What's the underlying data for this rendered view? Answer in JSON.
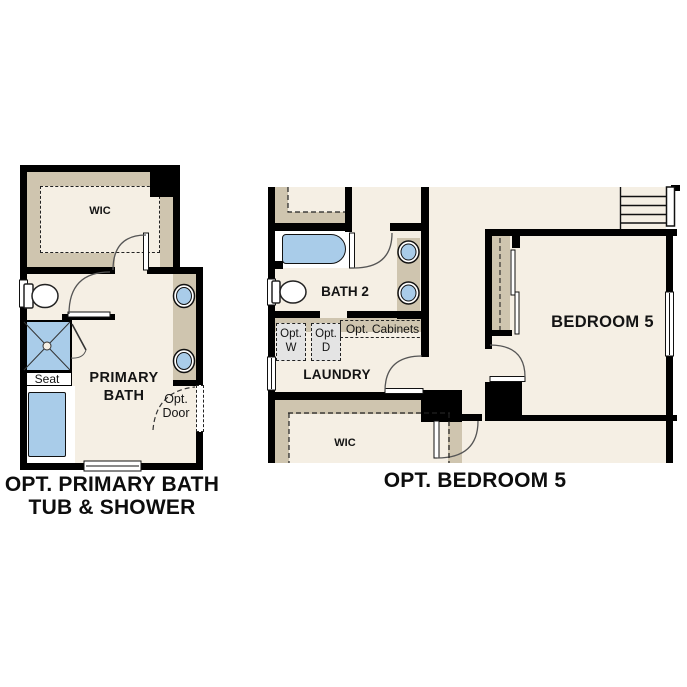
{
  "colors": {
    "floor": "#f5efe4",
    "cabinet": "#cfc5af",
    "fixture_blue": "#a9cce9",
    "appliance_gray": "#e4e4e4",
    "wall": "#000000",
    "ink": "#111111"
  },
  "left_plan": {
    "caption_line1": "OPT. PRIMARY BATH",
    "caption_line2": "TUB & SHOWER",
    "wic_label": "WIC",
    "room_line1": "PRIMARY",
    "room_line2": "BATH",
    "seat_label": "Seat",
    "opt_door_line1": "Opt.",
    "opt_door_line2": "Door"
  },
  "right_plan": {
    "caption": "OPT. BEDROOM 5",
    "bath_label": "BATH 2",
    "laundry_label": "LAUNDRY",
    "wic_label": "WIC",
    "bedroom_label": "BEDROOM 5",
    "opt_washer_line1": "Opt.",
    "opt_washer_line2": "W",
    "opt_dryer_line1": "Opt.",
    "opt_dryer_line2": "D",
    "opt_cabinets_label": "Opt. Cabinets"
  }
}
